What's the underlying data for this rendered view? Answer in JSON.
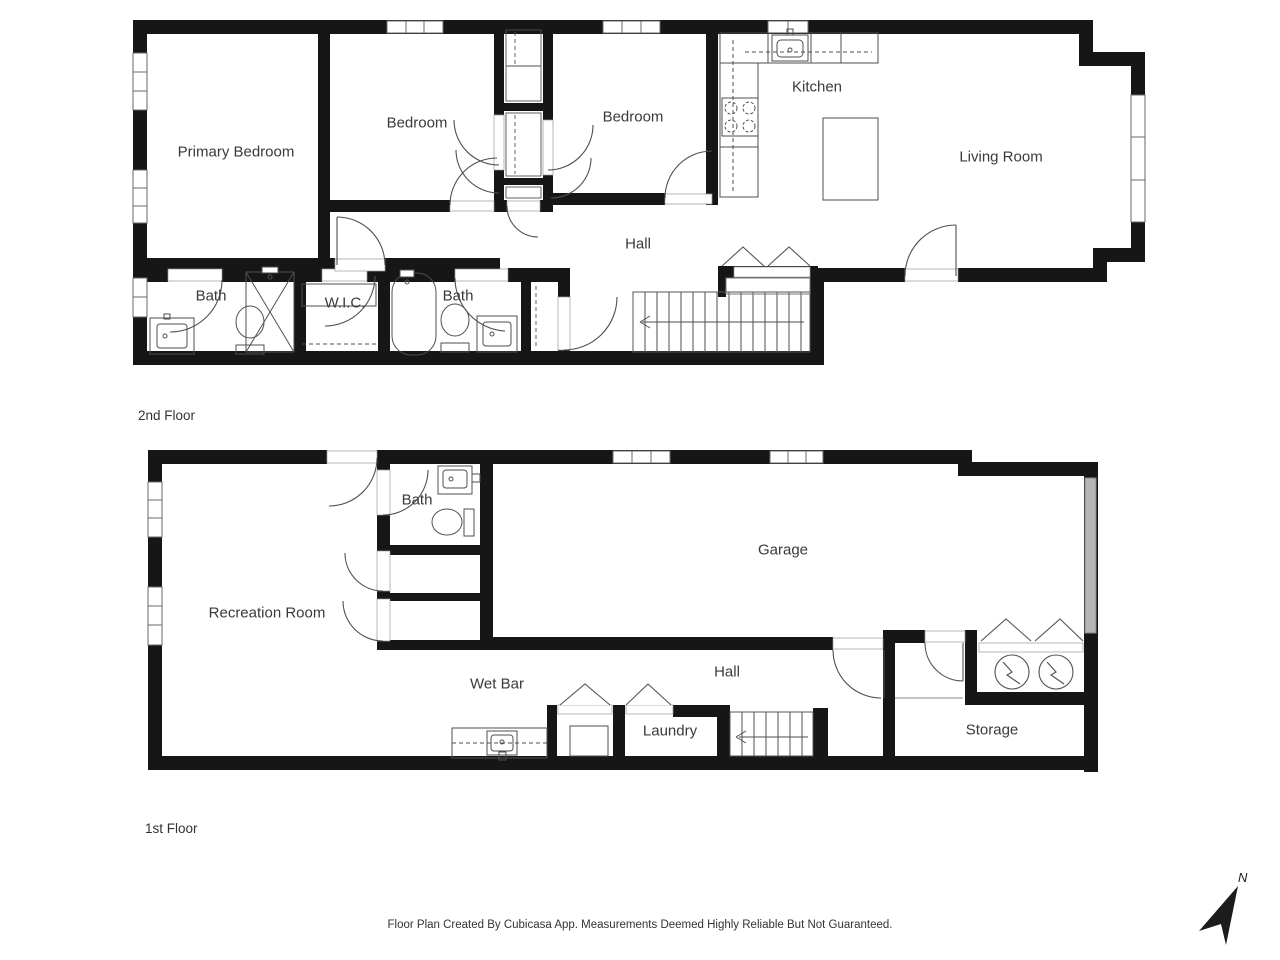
{
  "floors": [
    {
      "name": "2nd Floor",
      "rooms": [
        "Primary Bedroom",
        "Bedroom",
        "Bedroom",
        "Kitchen",
        "Living Room",
        "Hall",
        "Bath",
        "W.I.C.",
        "Bath"
      ]
    },
    {
      "name": "1st Floor",
      "rooms": [
        "Bath",
        "Garage",
        "Recreation Room",
        "Wet Bar",
        "Hall",
        "Laundry",
        "Storage"
      ]
    }
  ],
  "compass": {
    "label": "N"
  },
  "footer": "Floor Plan Created By Cubicasa App. Measurements Deemed Highly Reliable But Not Guaranteed.",
  "icons": [
    "toilet-icon",
    "sink-icon",
    "bathtub-icon",
    "shower-icon",
    "stove-icon",
    "kitchen-island-icon",
    "stairs-icon",
    "door-arc-icon",
    "window-icon",
    "water-heater-icon",
    "north-arrow-icon",
    "wet-bar-counter-icon",
    "washer-icon"
  ],
  "colors": {
    "wall": "#161616",
    "fixture_line": "#4f4f4f",
    "light_line": "#8a8a8a",
    "text": "#3a3a3a",
    "garage_door": "#b5b5b5"
  }
}
